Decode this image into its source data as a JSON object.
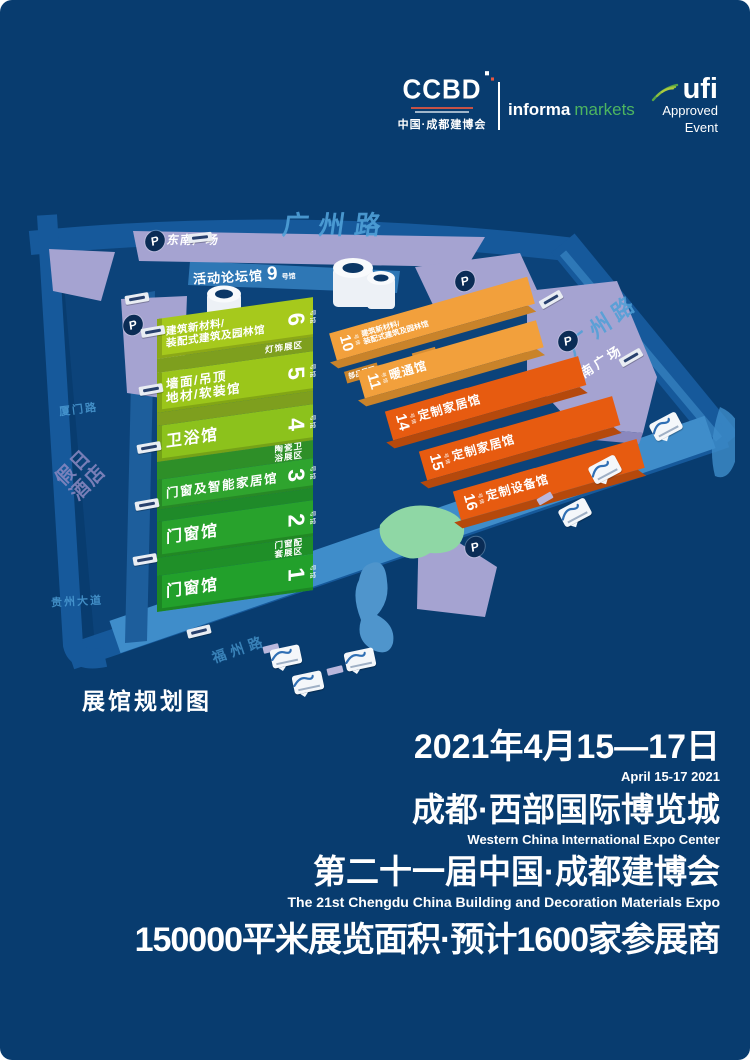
{
  "header": {
    "ccbd": {
      "logo": "CCBD",
      "subtitle": "中国·成都建博会"
    },
    "informa": {
      "part1": "informa",
      "part2": "markets"
    },
    "ufi": {
      "logo": "ufi",
      "line1": "Approved",
      "line2": "Event"
    }
  },
  "map": {
    "title": "展馆规划图",
    "parking_label": "P",
    "hall_suffix": "号馆",
    "roads": {
      "top": "广州路",
      "right": "广州路",
      "left_top": "厦门路",
      "left_bottom": "贵州大道",
      "bottom": "福州路"
    },
    "hotel": {
      "line1": "假日",
      "line2": "酒店"
    },
    "plazas": {
      "southeast": "东南广场",
      "south": "南广场"
    },
    "forum_hall": {
      "name": "活动论坛馆",
      "num": "9"
    },
    "green_halls": [
      {
        "num": "6",
        "line1": "建筑新材料/",
        "line2": "装配式建筑及园林馆",
        "zone": "灯饰展区"
      },
      {
        "num": "5",
        "line1": "墙面/吊顶",
        "line2": "地材/软装馆"
      },
      {
        "num": "4",
        "line1": "卫浴馆",
        "zone_l1": "陶瓷卫",
        "zone_l2": "浴展区"
      },
      {
        "num": "3",
        "line1": "门窗及智能家居馆"
      },
      {
        "num": "2",
        "line1": "门窗馆",
        "zone_l1": "门窗配",
        "zone_l2": "套展区"
      },
      {
        "num": "1",
        "line1": "门窗馆"
      }
    ],
    "orange_halls": [
      {
        "num": "10",
        "line1": "建筑新材料/",
        "line2": "装配式建筑及园林馆"
      },
      {
        "num": "11",
        "line1": "暖通馆",
        "zone": "部品展区"
      },
      {
        "num": "14",
        "line1": "定制家居馆"
      },
      {
        "num": "15",
        "line1": "定制家居馆"
      },
      {
        "num": "16",
        "line1": "定制设备馆"
      }
    ]
  },
  "footer": {
    "date_cn": "2021年4月15—17日",
    "date_en": "April 15-17 2021",
    "venue_cn": "成都·西部国际博览城",
    "venue_en": "Western China International Expo Center",
    "event_cn": "第二十一届中国·成都建博会",
    "event_en": "The 21st Chengdu China Building and Decoration Materials Expo",
    "stats": "150000平米展览面积·预计1600家参展商"
  },
  "colors": {
    "background": "#083C6F",
    "road_blue": "#16599B",
    "apron_blue": "#3F8DCA",
    "hall_green": "#23A12C",
    "hall_lime": "#A6C91C",
    "hall_orange_light": "#F2A03C",
    "hall_orange_dark": "#E75B10",
    "plaza_purple": "#A5A3D1",
    "brand_green": "#4DB560"
  }
}
